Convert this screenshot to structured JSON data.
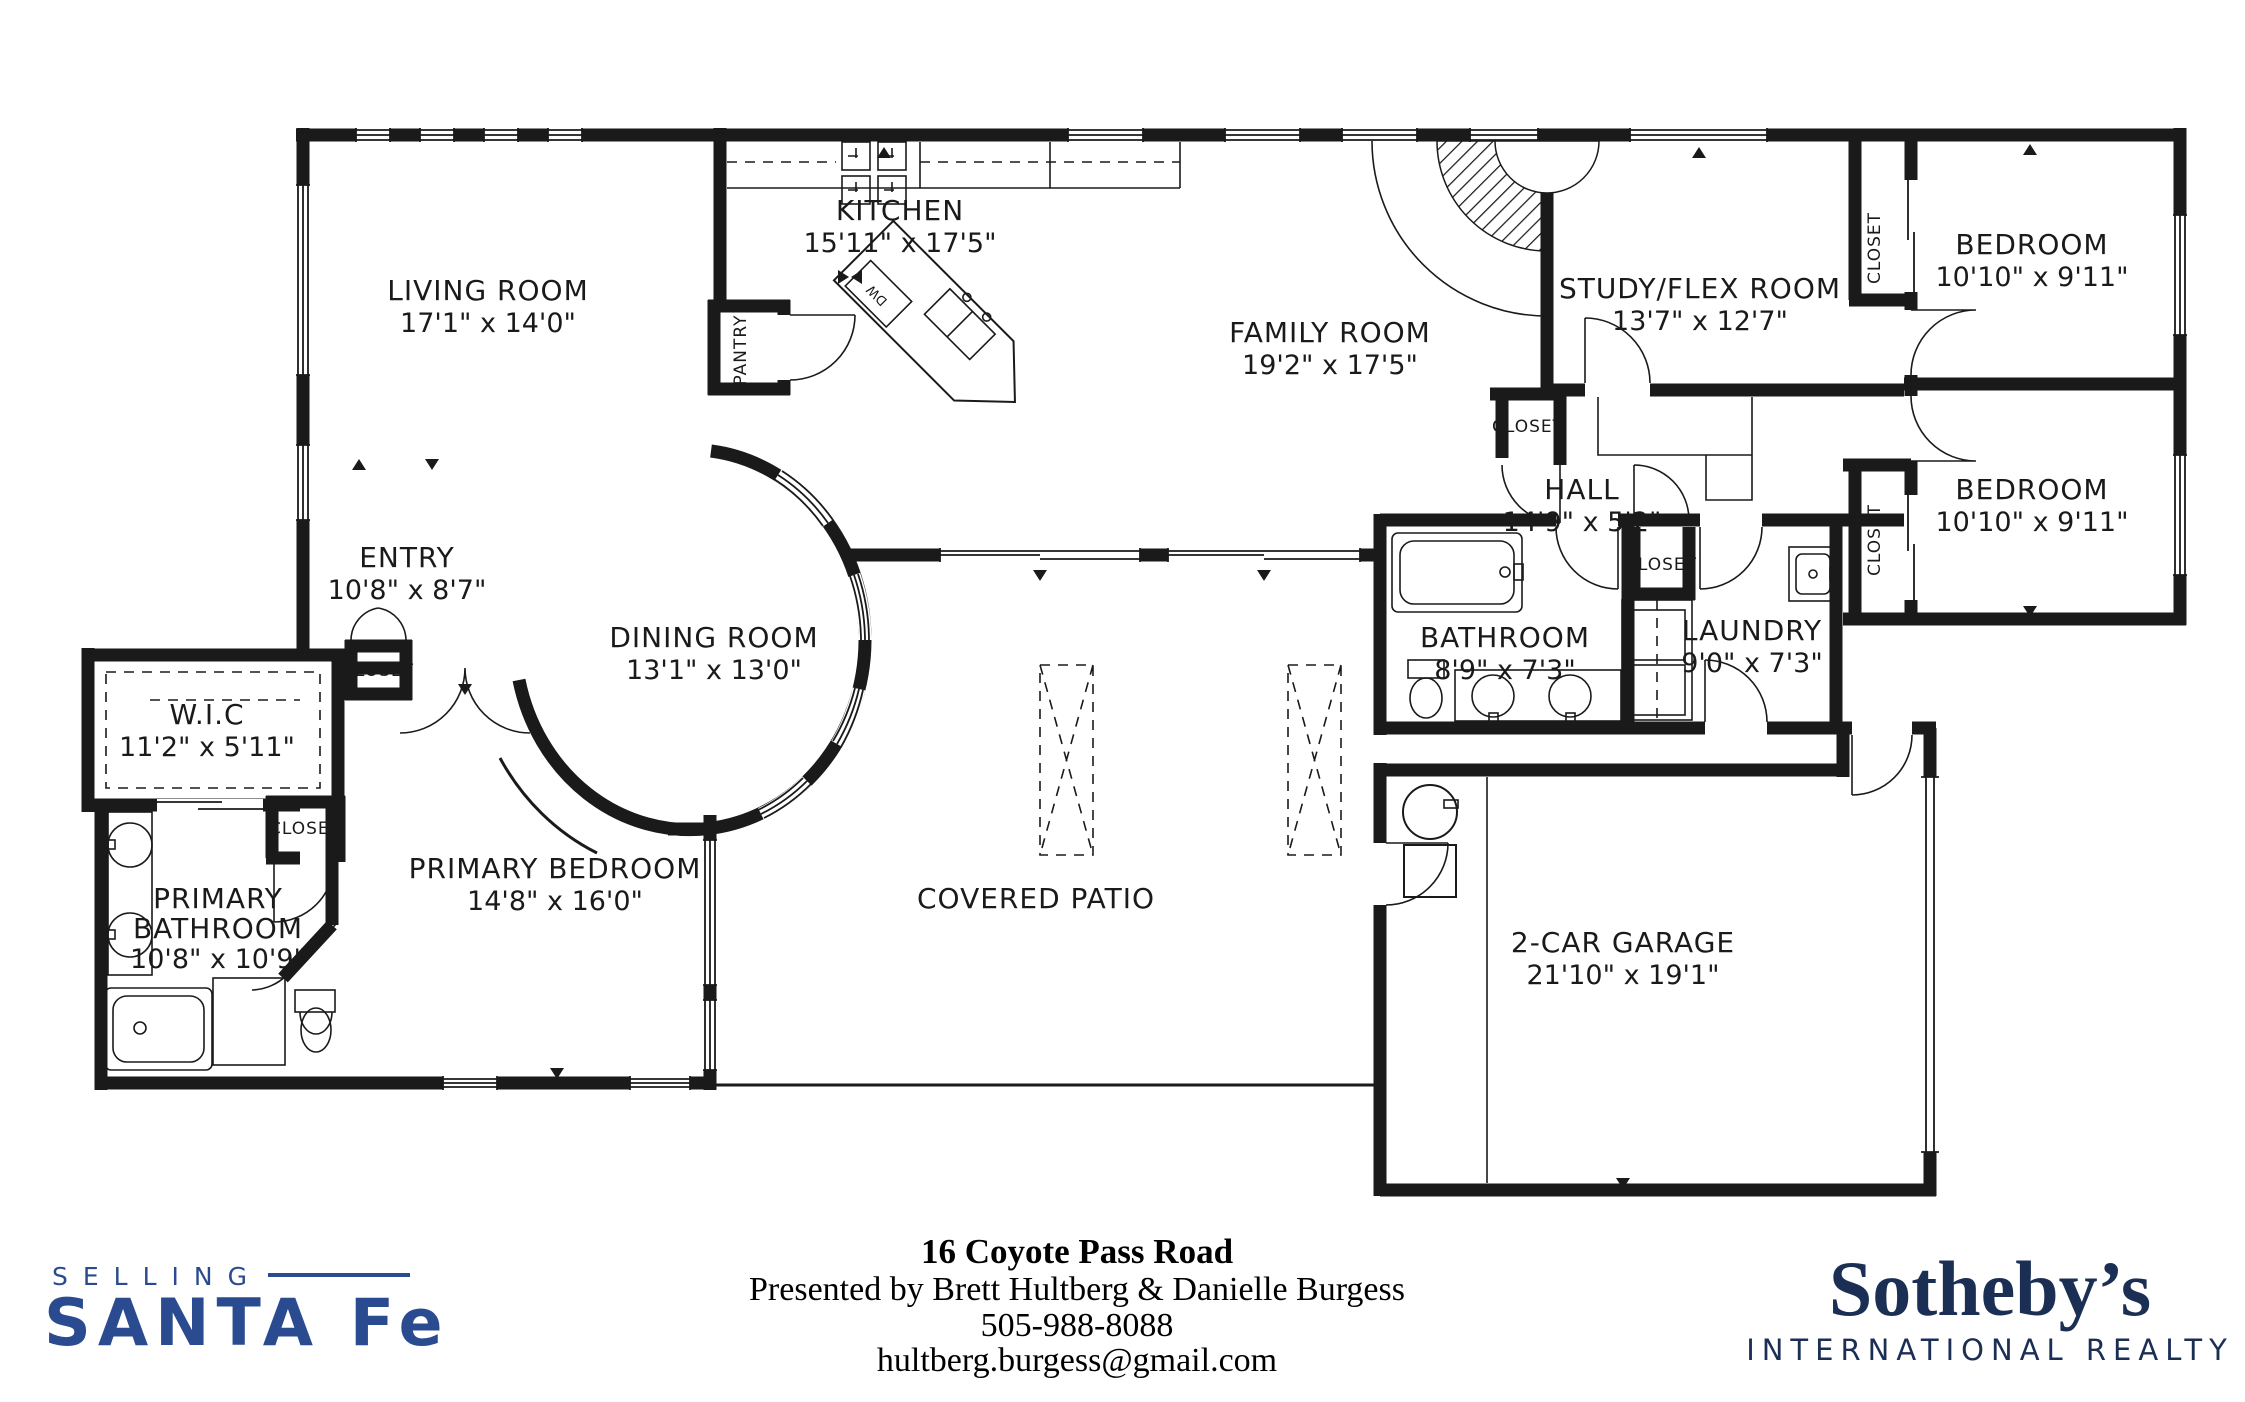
{
  "meta": {
    "title": "16 Coyote Pass Road Floor Plan"
  },
  "rooms": [
    {
      "name": "LIVING ROOM",
      "dims": "17'1\" x 14'0\""
    },
    {
      "name": "KITCHEN",
      "dims": "15'11\" x 17'5\""
    },
    {
      "name": "FAMILY ROOM",
      "dims": "19'2\" x 17'5\""
    },
    {
      "name": "STUDY/FLEX ROOM",
      "dims": "13'7\" x 12'7\""
    },
    {
      "name": "BEDROOM",
      "dims": "10'10\" x 9'11\""
    },
    {
      "name": "BEDROOM",
      "dims": "10'10\" x 9'11\""
    },
    {
      "name": "HALL",
      "dims": "14'9\" x 5'2\""
    },
    {
      "name": "ENTRY",
      "dims": "10'8\" x 8'7\""
    },
    {
      "name": "DINING ROOM",
      "dims": "13'1\" x 13'0\""
    },
    {
      "name": "W.I.C",
      "dims": "11'2\" x 5'11\""
    },
    {
      "name": "BATHROOM",
      "dims": "8'9\" x 7'3\""
    },
    {
      "name": "LAUNDRY",
      "dims": "9'0\" x 7'3\""
    },
    {
      "name": "PRIMARY BEDROOM",
      "dims": "14'8\" x 16'0\""
    },
    {
      "name": "PRIMARY BATHROOM",
      "line1": "PRIMARY",
      "line2": "BATHROOM",
      "dims": "10'8\" x 10'9\""
    },
    {
      "name": "COVERED PATIO",
      "dims": ""
    },
    {
      "name": "2-CAR GARAGE",
      "dims": "21'10\" x 19'1\""
    }
  ],
  "labels": {
    "closet": "CLOSET",
    "pantry": "PANTRY",
    "dw": "DW"
  },
  "footer": {
    "address": "16 Coyote Pass Road",
    "presented_by": "Presented by Brett Hultberg & Danielle Burgess",
    "phone": "505-988-8088",
    "email": "hultberg.burgess@gmail.com"
  },
  "logos": {
    "selling_word": "SELLING",
    "santafe_word": "SANTA Fe",
    "sothebys_word": "Sotheby’s",
    "sothebys_sub": "INTERNATIONAL REALTY"
  },
  "colors": {
    "line": "#1a1a1a",
    "santafe_blue": "#2a4b8f",
    "sothebys_navy": "#1b2f54"
  }
}
